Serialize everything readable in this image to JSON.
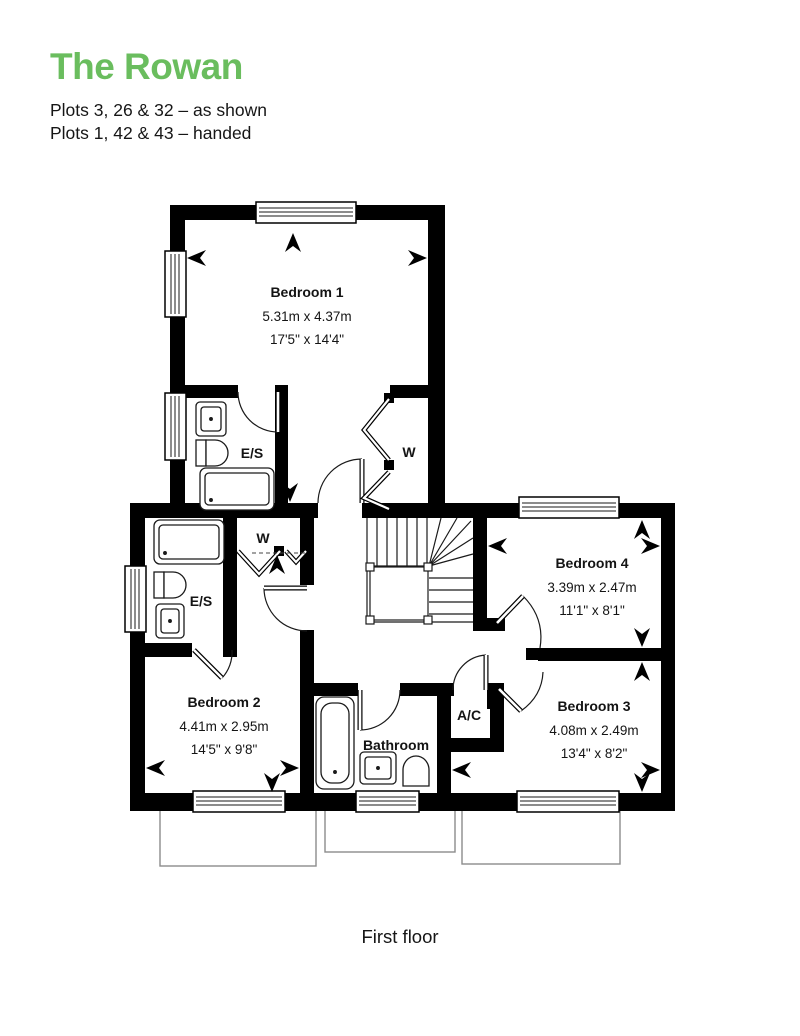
{
  "header": {
    "title": "The Rowan",
    "plots_line1": "Plots 3, 26 & 32 – as shown",
    "plots_line2": "Plots 1, 42 & 43 – handed"
  },
  "caption": "First floor",
  "colors": {
    "accent_green": "#6abd5e",
    "wall": "#000000",
    "thin_line": "#1a1a1a",
    "ground_outline": "#8b8b8b"
  },
  "rooms": {
    "bedroom1": {
      "name": "Bedroom 1",
      "metric": "5.31m x 4.37m",
      "imperial": "17'5\" x 14'4\""
    },
    "bedroom2": {
      "name": "Bedroom 2",
      "metric": "4.41m x 2.95m",
      "imperial": "14'5\" x 9'8\""
    },
    "bedroom3": {
      "name": "Bedroom 3",
      "metric": "4.08m x 2.49m",
      "imperial": "13'4\" x 8'2\""
    },
    "bedroom4": {
      "name": "Bedroom 4",
      "metric": "3.39m x 2.47m",
      "imperial": "11'1\" x 8'1\""
    },
    "bathroom": {
      "name": "Bathroom"
    },
    "ensuite1": {
      "name": "E/S"
    },
    "ensuite2": {
      "name": "E/S"
    },
    "wardrobe1": {
      "name": "W"
    },
    "wardrobe2": {
      "name": "W"
    },
    "airing_cupboard": {
      "name": "A/C"
    }
  }
}
